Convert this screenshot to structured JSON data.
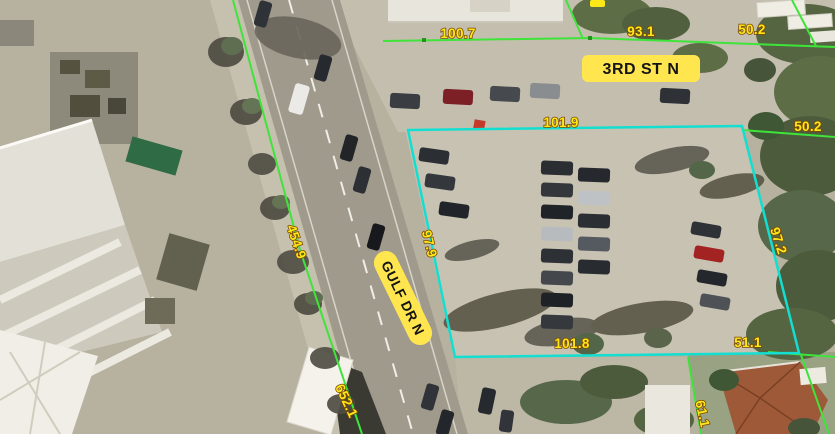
{
  "map": {
    "view_type": "aerial-parcel-view",
    "street_labels": [
      {
        "name": "3RD ST N"
      },
      {
        "name": "GULF DR N"
      }
    ],
    "dimension_labels": [
      {
        "text": "100.7"
      },
      {
        "text": "93.1"
      },
      {
        "text": "50.2"
      },
      {
        "text": "50.2"
      },
      {
        "text": "101.9"
      },
      {
        "text": "97.9"
      },
      {
        "text": "454.9"
      },
      {
        "text": "97.2"
      },
      {
        "text": "101.8"
      },
      {
        "text": "51.1"
      },
      {
        "text": "652.1"
      },
      {
        "text": "61.1"
      }
    ],
    "colors": {
      "parcel_line": "#3fe43a",
      "selected_parcel": "#12dfd0",
      "dimension_text": "#ffe818",
      "street_label_bg": "#ffe64f",
      "street_label_text": "#141414"
    }
  }
}
